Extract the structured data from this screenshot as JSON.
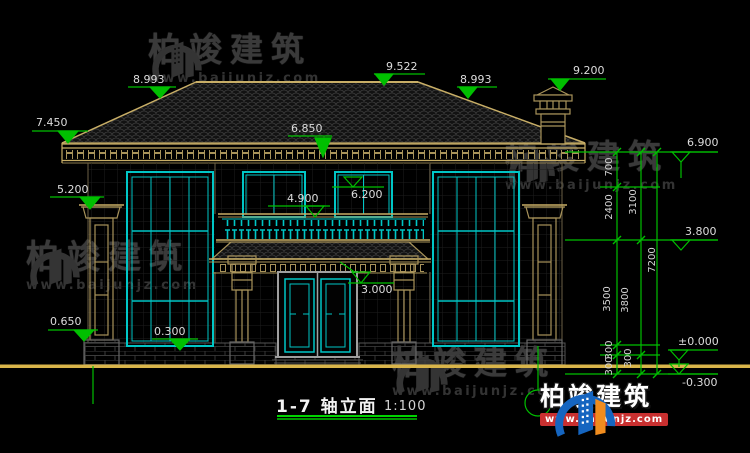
{
  "title": {
    "label": "1-7  轴立面",
    "scale": "1:100"
  },
  "brand": {
    "name": "柏竣建筑",
    "url": "www.baijunjz.com"
  },
  "levels": {
    "l9522": "9.522",
    "l8993_left": "8.993",
    "l8993_right": "8.993",
    "l9200": "9.200",
    "l7450": "7.450",
    "l6900": "6.900",
    "l6850": "6.850",
    "l6200": "6.200",
    "l5200": "5.200",
    "l4900": "4.900",
    "l3800": "3.800",
    "l3000": "3.000",
    "l0650": "0.650",
    "l0300": "0.300",
    "l0000": "±0.000",
    "lm0300": "-0.300"
  },
  "dims": {
    "d700": "700",
    "d2400": "2400",
    "d3100": "3100",
    "d3500": "3500",
    "d3800": "3800",
    "d7200": "7200",
    "d300a": "300",
    "d300b": "300",
    "d300c": "300"
  },
  "colors": {
    "background": "#000000",
    "dim_green": "#00bf00",
    "cad_tan": "#a8935a",
    "cad_tan_bright": "#c8ae66",
    "window_cyan": "#00c6c6",
    "door_gray": "#9f9f9f",
    "ground_yellow": "#d9b54a",
    "watermark_gray": "#3a3a3a",
    "logo_blue": "#1565c0",
    "logo_orange": "#f08c1e",
    "url_bar_red": "#c93030",
    "title_white": "#f2f2f2"
  }
}
